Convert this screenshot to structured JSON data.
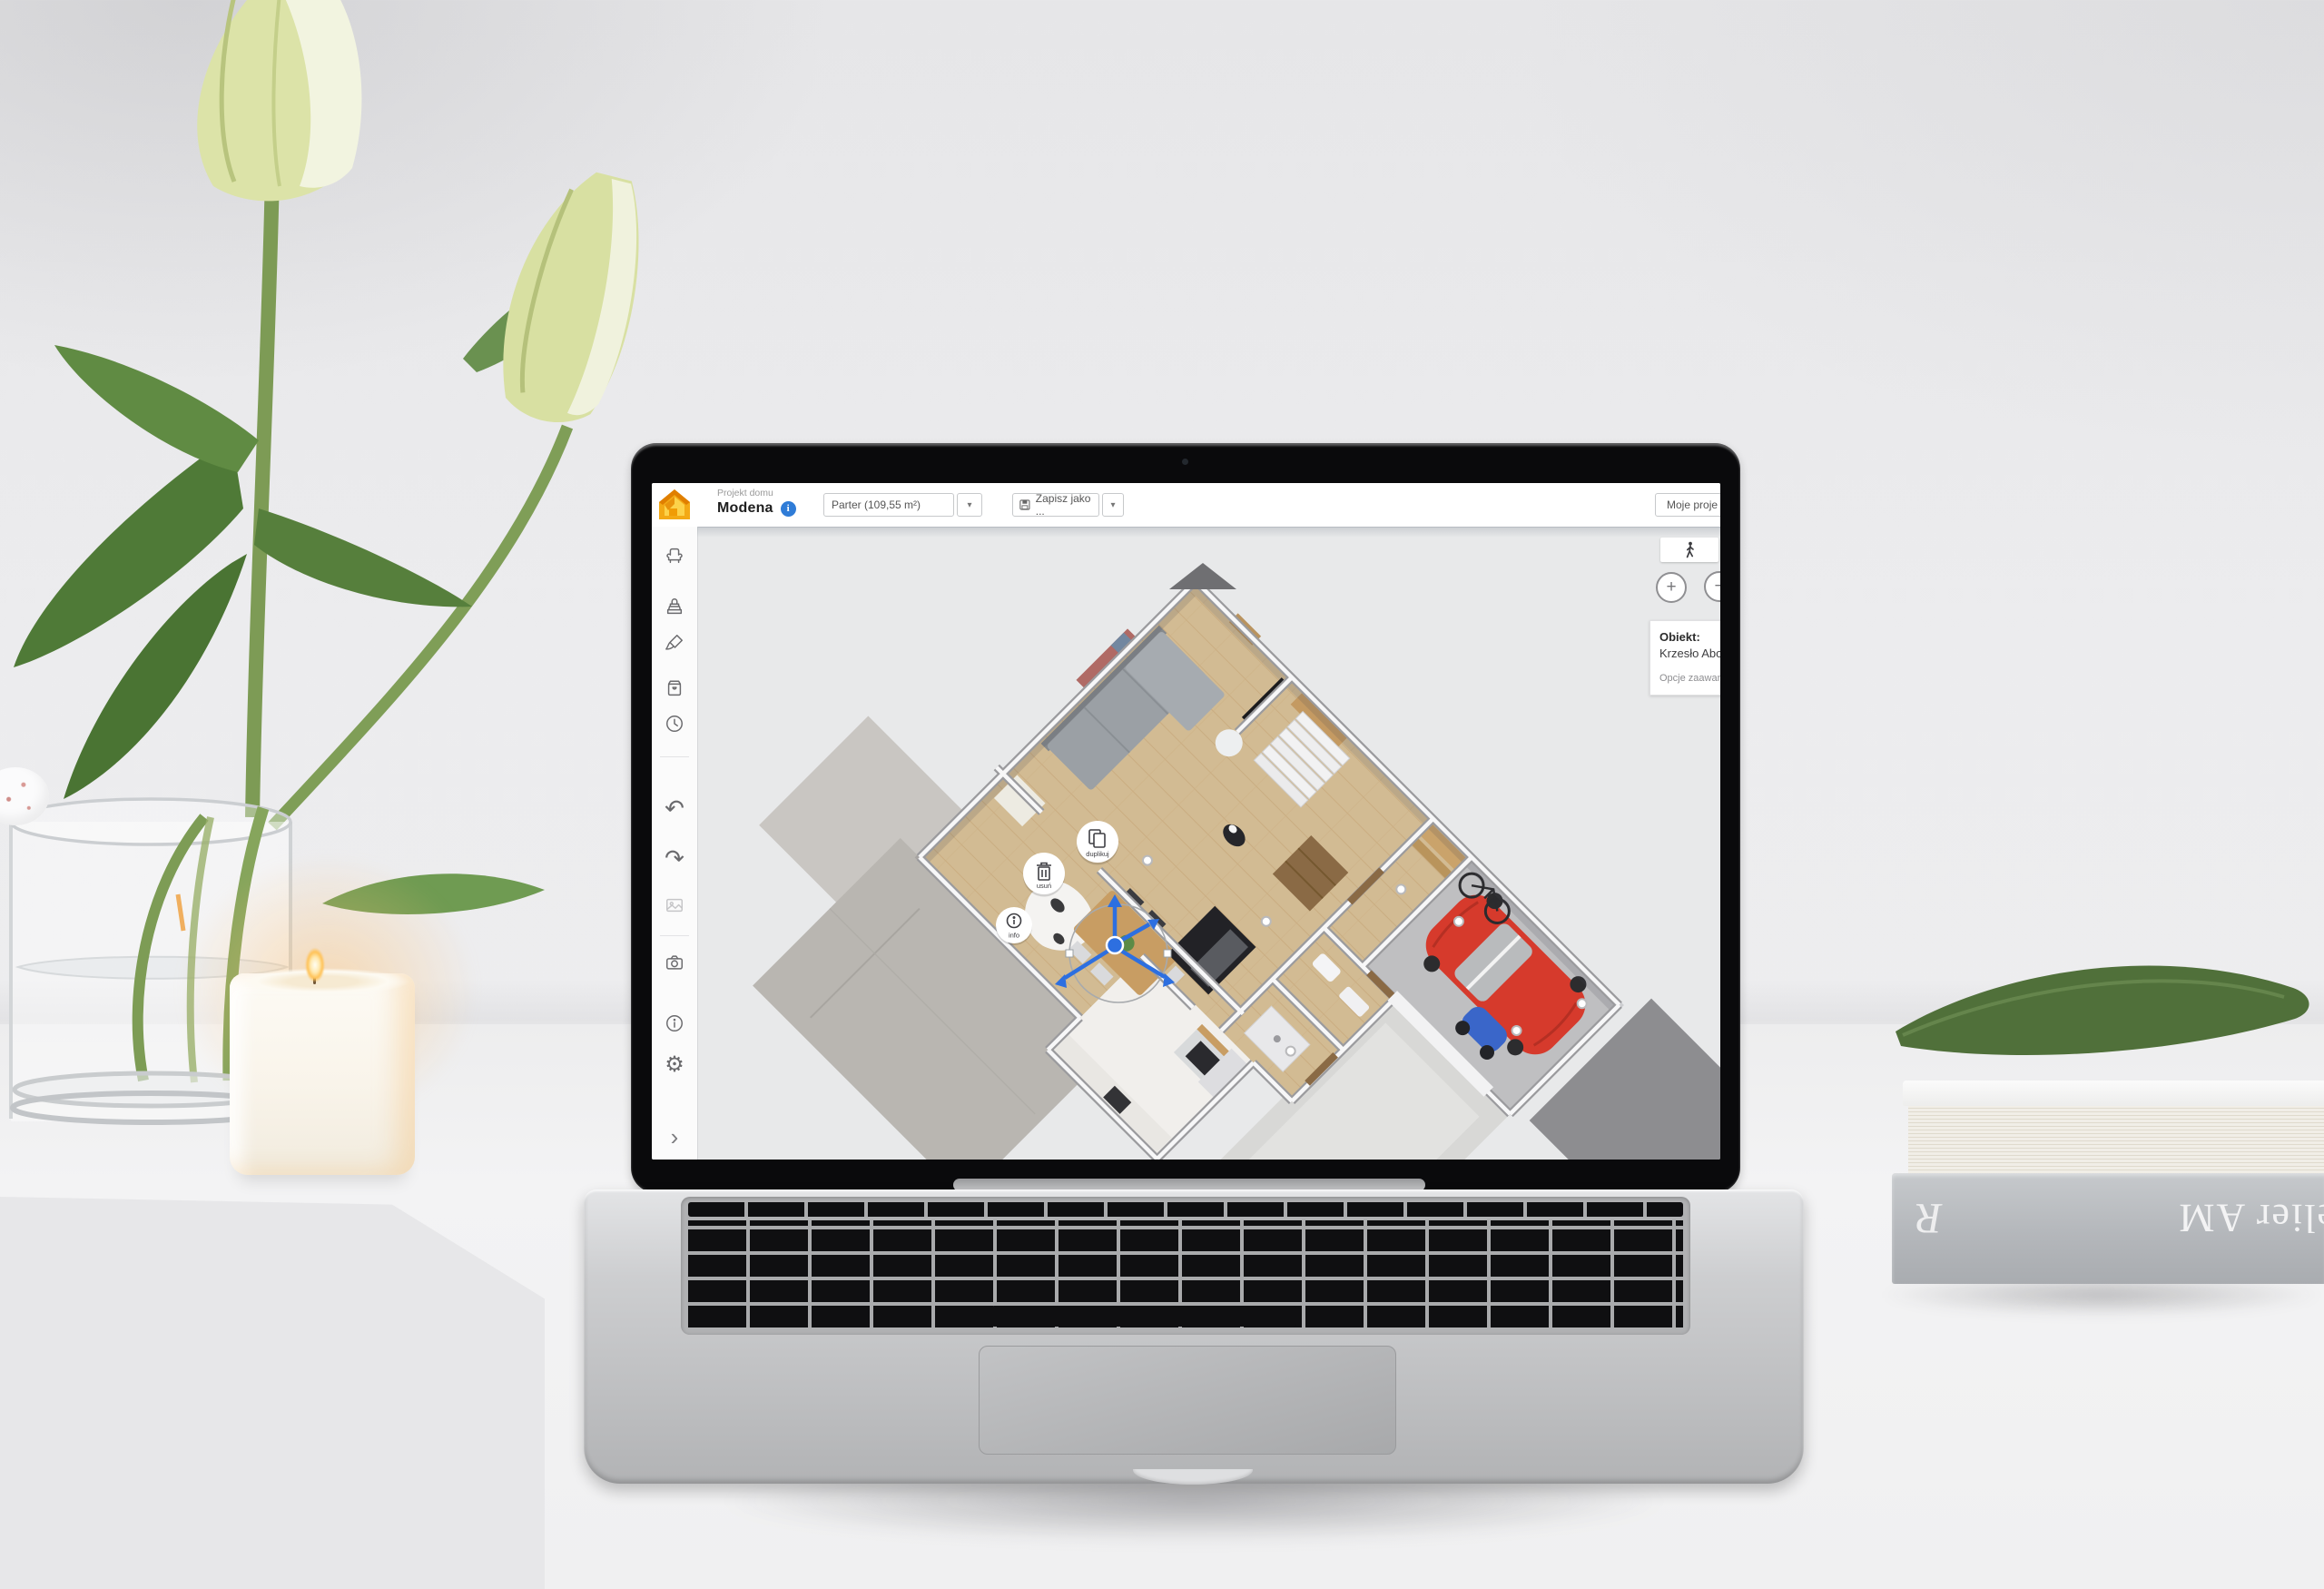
{
  "topbar": {
    "project_label": "Projekt domu",
    "project_name": "Modena",
    "floor_selector_value": "Parter (109,55 m²)",
    "save_button_label": "Zapisz jako ...",
    "my_projects_button_label": "Moje proje"
  },
  "icons": {
    "caret_glyph": "▾",
    "undo_glyph": "↶",
    "redo_glyph": "↷",
    "gear_glyph": "⚙",
    "chevron_glyph": "›",
    "info_badge_glyph": "i"
  },
  "sidebar": {
    "items": [
      {
        "icon": "furniture-chair-icon"
      },
      {
        "icon": "build-stamp-icon"
      },
      {
        "icon": "paintbrush-icon"
      },
      {
        "icon": "product-box-icon"
      },
      {
        "icon": "history-clock-icon"
      },
      {
        "icon": "undo-icon"
      },
      {
        "icon": "redo-icon"
      },
      {
        "icon": "gallery-icon",
        "disabled": true
      },
      {
        "icon": "camera-icon"
      },
      {
        "icon": "info-icon"
      },
      {
        "icon": "settings-gear-icon"
      },
      {
        "icon": "collapse-chevron-icon"
      }
    ]
  },
  "canvas": {
    "action_buttons": [
      {
        "id": "duplicate",
        "label": "duplikuj"
      },
      {
        "id": "delete",
        "label": "usuń"
      },
      {
        "id": "info",
        "label": "info"
      }
    ],
    "object_panel": {
      "title": "Obiekt:",
      "object_name": "Krzesło Abo",
      "advanced_options_label": "Opcje zaawansow"
    },
    "controls": {
      "zoom_in": "+",
      "zoom_out": "−",
      "walk_mode_icon": "walk-person-icon"
    }
  },
  "colors": {
    "accent_blue": "#2f7cd7",
    "logo_orange": "#f3a915",
    "car_red": "#d63a2c",
    "gizmo_blue": "#2d6fe0",
    "canvas_gray": "#e8e9ea"
  },
  "photo_props": {
    "book_spine_text": "Atelier AM",
    "book_monogram": "R"
  }
}
